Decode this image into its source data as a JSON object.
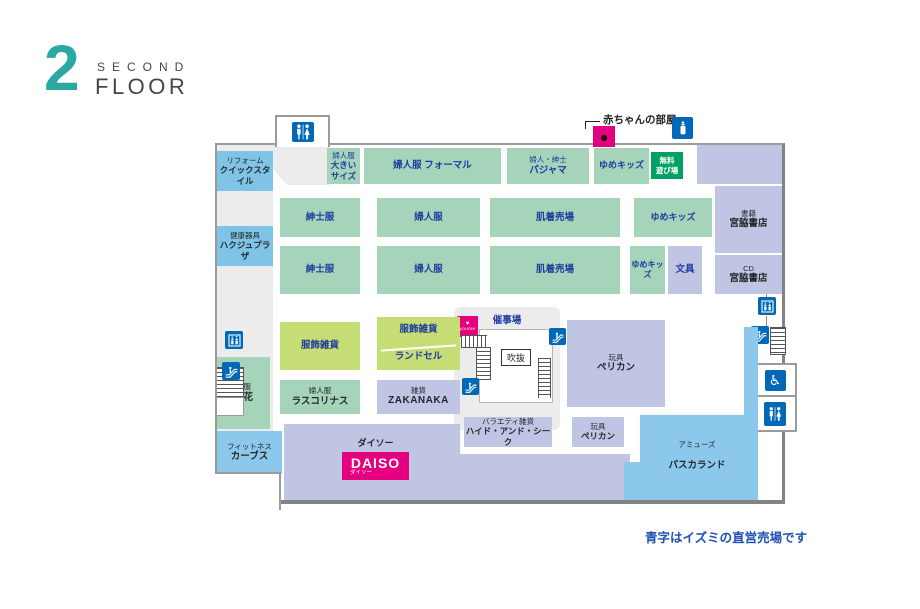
{
  "header": {
    "number": "2",
    "word1": "SECOND",
    "word2": "FLOOR"
  },
  "note": "青字はイズミの直営売場です",
  "annotations": {
    "baby_room": "赤ちゃんの部屋"
  },
  "sections": {
    "reform": {
      "sub": "リフォーム",
      "name": "クイックスタイル"
    },
    "hakuju": {
      "sub": "健康器具",
      "name": "ハクジュプラザ"
    },
    "suzuka": {
      "sub": "呉服",
      "name": "鈴花"
    },
    "curves": {
      "sub": "フィットネス",
      "name": "カーブス"
    },
    "ladies_large": {
      "sub": "婦人服",
      "name": "大きい\nサイズ"
    },
    "ladies_formal": {
      "name": "婦人服 フォーマル"
    },
    "pajama": {
      "sub": "婦人・紳士",
      "name": "パジャマ"
    },
    "yume_kids": {
      "name": "ゆめキッズ"
    },
    "free_play": {
      "name": "無料\n遊び場"
    },
    "mens": {
      "name": "紳士服"
    },
    "ladies": {
      "name": "婦人服"
    },
    "underwear": {
      "name": "肌着売場"
    },
    "stationery": {
      "name": "文具"
    },
    "books": {
      "sub": "書籍",
      "name": "宮脇書店"
    },
    "cd": {
      "sub": "CD",
      "name": "宮脇書店"
    },
    "accessories": {
      "name": "服飾雑貨"
    },
    "randoseru": {
      "name": "ランドセル"
    },
    "event_space": {
      "name": "催事場"
    },
    "atrium": {
      "name": "吹抜"
    },
    "toys": {
      "sub": "玩具",
      "name": "ペリカン"
    },
    "rascolinas": {
      "sub": "婦人服",
      "name": "ラスコリナス"
    },
    "zakanaka": {
      "sub": "雑貨",
      "name": "ZAKANAKA"
    },
    "hide_and_seek": {
      "sub": "バラエティ雑貨",
      "name": "ハイド・アンド・シーク"
    },
    "daiso": {
      "label": "ダイソー",
      "logo": "DAISO",
      "logo_sub": "ダイソー"
    },
    "pascal_land": {
      "sub": "アミューズ",
      "name": "パスカランド"
    }
  },
  "icons": {
    "restroom": "restroom-icon",
    "baby_bottle": "baby-bottle-icon",
    "elevator": "elevator-icon",
    "escalator": "escalator-icon",
    "wheelchair": "wheelchair-icon",
    "youme_mark": "youme-logo-badge"
  },
  "colors": {
    "teal_logo": "#2aa9a3",
    "section_green": "#a5d4ba",
    "section_lavender": "#bfc5e2",
    "section_yellowgreen": "#c6dc75",
    "tenant_blue": "#7fc4e6",
    "amuse_blue": "#8cc8eb",
    "badge_green": "#00a263",
    "magenta": "#e4007f",
    "icon_blue": "#0068b7",
    "text_blue": "#1e3c9e"
  }
}
